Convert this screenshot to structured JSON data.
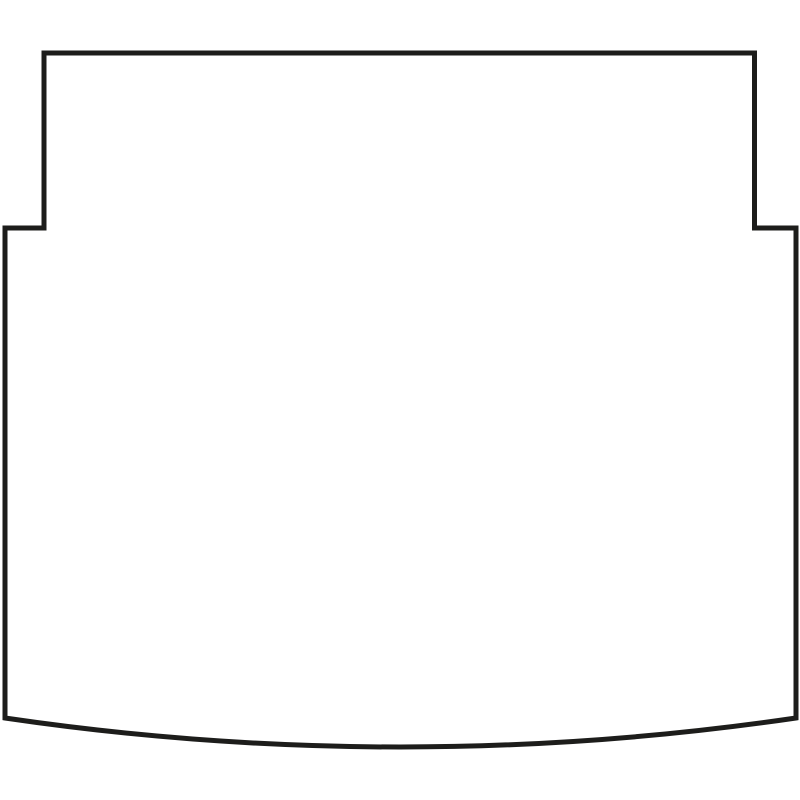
{
  "figure": {
    "description": "Black outline line-drawing of a car boot / cargo mat template: narrow rectangular section at top, stepped out on both sides, straight vertical sides, gently curved convex bottom edge",
    "background_color": "#ffffff",
    "outline": {
      "stroke_color": "#1d1d1b",
      "stroke_width": "5",
      "fill": "none",
      "viewbox": "0 0 800 800",
      "svg_path": "M 44 53 L 754.5 53 L 754.5 228 L 796 228 L 796 718 Q 400 776 5 718 L 5 228 L 44 228 Z",
      "key_points": {
        "top_edge_y": 53,
        "top_edge_x_left": 44,
        "top_edge_x_right": 754.5,
        "step_y": 228,
        "outer_left_x": 5,
        "outer_right_x": 796,
        "bottom_corner_y": 718,
        "bottom_curve_lowest_y": 746,
        "bottom_curve_control": [
          400,
          776
        ]
      }
    }
  }
}
